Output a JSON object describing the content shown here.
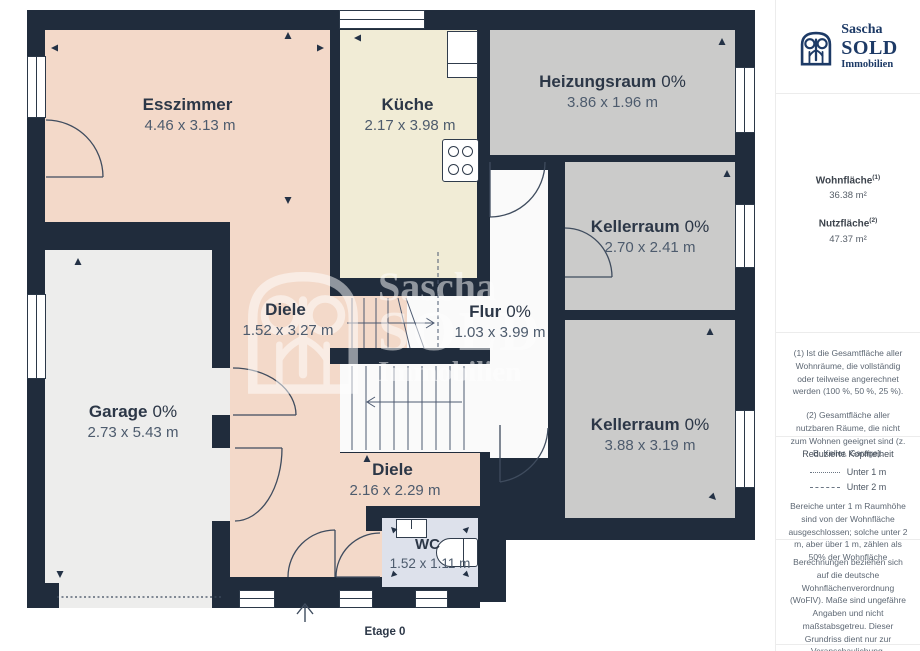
{
  "meta": {
    "floor_label": "Etage 0"
  },
  "rooms": [
    {
      "id": "esszimmer",
      "name": "Esszimmer",
      "pct": "",
      "dims": "4.46 x 3.13 m"
    },
    {
      "id": "kueche",
      "name": "Küche",
      "pct": "",
      "dims": "2.17 x 3.98 m"
    },
    {
      "id": "heizungsraum",
      "name": "Heizungsraum",
      "pct": "0%",
      "dims": "3.86 x 1.96 m"
    },
    {
      "id": "kellerraum-1",
      "name": "Kellerraum",
      "pct": "0%",
      "dims": "2.70 x 2.41 m"
    },
    {
      "id": "diele-1",
      "name": "Diele",
      "pct": "",
      "dims": "1.52 x 3.27 m"
    },
    {
      "id": "flur",
      "name": "Flur",
      "pct": "0%",
      "dims": "1.03 x 3.99 m"
    },
    {
      "id": "garage",
      "name": "Garage",
      "pct": "0%",
      "dims": "2.73 x 5.43 m"
    },
    {
      "id": "kellerraum-2",
      "name": "Kellerraum",
      "pct": "0%",
      "dims": "3.88 x 3.19 m"
    },
    {
      "id": "diele-2",
      "name": "Diele",
      "pct": "",
      "dims": "2.16 x 2.29 m"
    },
    {
      "id": "wc",
      "name": "WC",
      "pct": "",
      "dims": "1.52 x 1.11 m"
    }
  ],
  "watermark": {
    "line1": "Sascha",
    "line2": "SOLD",
    "line3": "Immobilien"
  },
  "sidebar": {
    "brand": {
      "line1": "Sascha",
      "line2": "SOLD",
      "line3": "Immobilien"
    },
    "stats": [
      {
        "label": "Wohnfläche",
        "sup": "(1)",
        "value": "36.38 m²"
      },
      {
        "label": "Nutzfläche",
        "sup": "(2)",
        "value": "47.37 m²"
      }
    ],
    "footnote1": "(1) Ist die Gesamtfläche aller Wohnräume, die vollständig oder teilweise angerechnet werden (100 %, 50 %, 25 %).",
    "footnote2": "(2) Gesamtfläche aller nutzbaren Räume, die nicht zum Wohnen geeignet sind (z. B. Keller, Garage).",
    "headroom": {
      "title": "Reduzierte Kopffreiheit",
      "legend": [
        {
          "style": "dotted",
          "label": "Unter 1 m"
        },
        {
          "style": "dashed",
          "label": "Unter 2 m"
        }
      ],
      "note": "Bereiche unter 1 m Raumhöhe sind von der Wohnfläche ausgeschlossen; solche unter 2 m, aber über 1 m, zählen als 50% der Wohnfläche"
    },
    "disclaimer": "Berechnungen beziehen sich auf die deutsche Wohnflächenverordnung (WoFlV). Maße sind ungefähre Angaben und nicht maßstabsgetreu. Dieser Grundriss dient nur zur Veranschaulichung.",
    "vendor": {
      "name": "GIRAFFE",
      "suffix": "360"
    }
  },
  "colors": {
    "wall": "#202c3c",
    "living": "#f3d9c9",
    "kitchen": "#f1ecd6",
    "utility": "#cbcbca",
    "garage": "#ededec",
    "hall": "#fafafa",
    "wc": "#dde1eb",
    "brand_navy": "#1d3a66"
  }
}
